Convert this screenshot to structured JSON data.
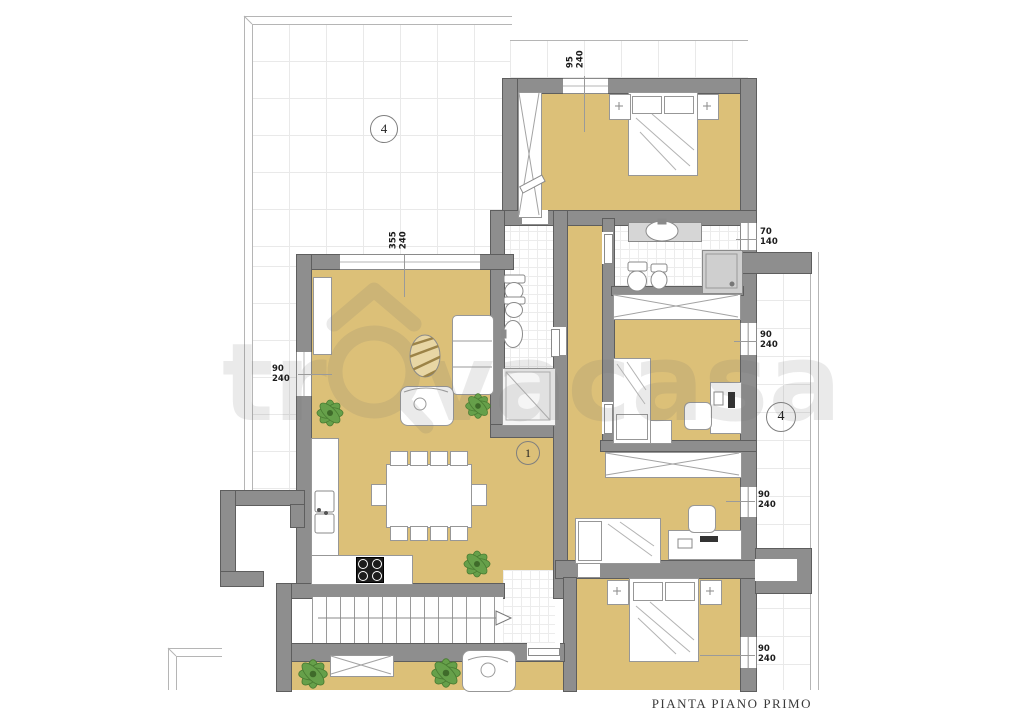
{
  "plan": {
    "title": "PIANTA PIANO PRIMO",
    "watermark": {
      "prefix": "tr",
      "suffix": "vacasa"
    },
    "room_markers": [
      {
        "id": "terrace-upper",
        "label": "4"
      },
      {
        "id": "living-dining",
        "label": "1"
      },
      {
        "id": "balcony-right",
        "label": "4"
      }
    ],
    "dimension_labels": [
      {
        "id": "bedroom1-window",
        "width": "95",
        "height": "240"
      },
      {
        "id": "living-top-window",
        "width": "355",
        "height": "240"
      },
      {
        "id": "bathroom1-window",
        "width": "70",
        "height": "140"
      },
      {
        "id": "bedroom2-window",
        "width": "90",
        "height": "240"
      },
      {
        "id": "bedroom3-window",
        "width": "90",
        "height": "240"
      },
      {
        "id": "bedroom4-window",
        "width": "90",
        "height": "240"
      },
      {
        "id": "living-left-window",
        "width": "90",
        "height": "240"
      }
    ],
    "colors": {
      "wall": "#8e8e8e",
      "floor": "#dcc078",
      "tile_line": "#e9e9e9",
      "plant": "#66a04a",
      "watermark": "#707070"
    }
  }
}
